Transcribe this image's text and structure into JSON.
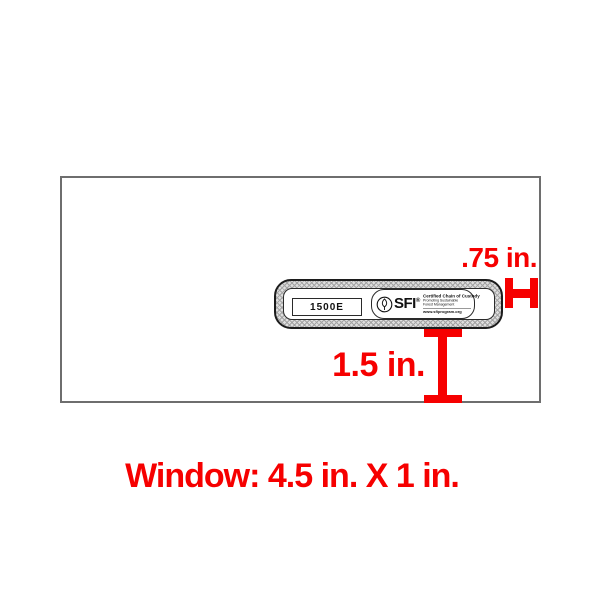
{
  "diagram": {
    "envelope": {
      "window_label": "1500E"
    },
    "sfi_logo": {
      "acronym": "SFI",
      "registered_mark": "®",
      "certification_title": "Certified Chain of Custody",
      "tagline_line1": "Promoting Sustainable",
      "tagline_line2": "Forest Management",
      "website": "www.sfiprogram.org"
    },
    "annotations": {
      "right_offset_label": ".75 in.",
      "bottom_offset_label": "1.5 in.",
      "caption": "Window: 4.5 in. X 1 in."
    }
  },
  "icons": {
    "leaf_icon": "sfi-leaf"
  },
  "colors": {
    "annotation-red": "#f60000",
    "envelope-border": "#6e6e6e",
    "window-border": "#1c1c1c"
  }
}
